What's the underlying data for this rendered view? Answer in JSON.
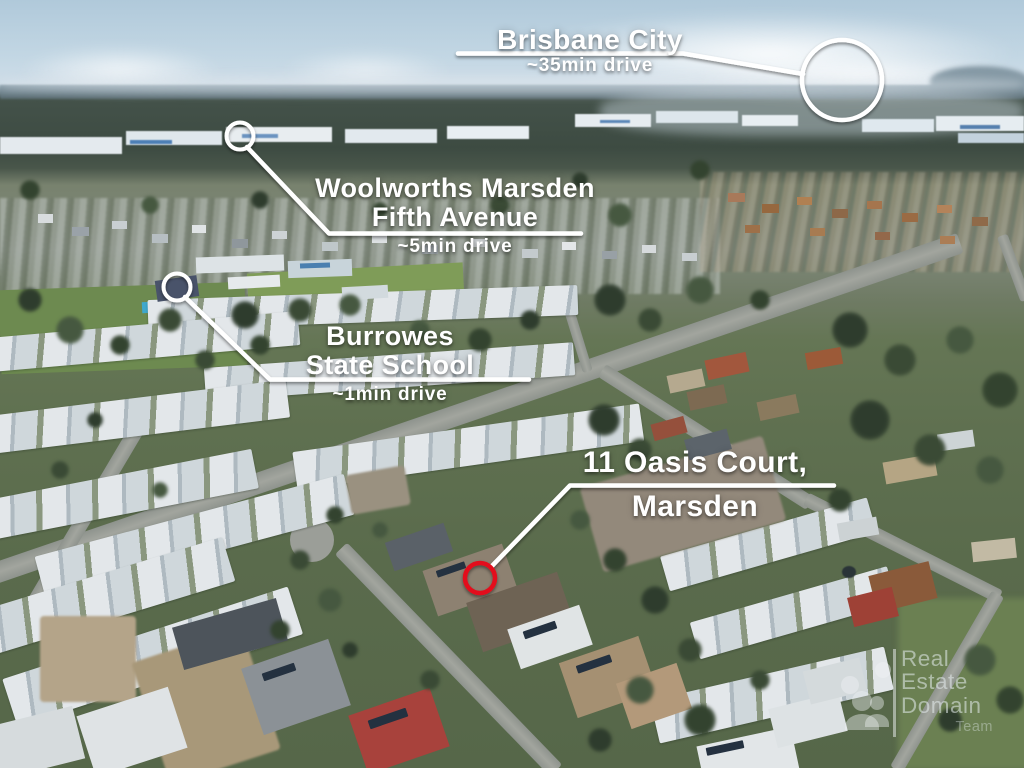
{
  "callouts": {
    "brisbane": {
      "title": "Brisbane City",
      "drive_time": "~35min drive"
    },
    "woolworths": {
      "line1": "Woolworths Marsden",
      "line2": "Fifth Avenue",
      "drive_time": "~5min drive"
    },
    "school": {
      "line1": "Burrowes",
      "line2": "State School",
      "drive_time": "~1min drive"
    },
    "property": {
      "line1": "11 Oasis Court,",
      "line2": "Marsden"
    }
  },
  "watermark": {
    "word1": "Real",
    "word2": "Estate",
    "word3": "Domain",
    "word4": "Team"
  },
  "colors": {
    "annotation_white": "#ffffff",
    "property_highlight_red": "#e3101c",
    "sky_blue": "#b7cedd",
    "grass_green": "#5f7050"
  }
}
